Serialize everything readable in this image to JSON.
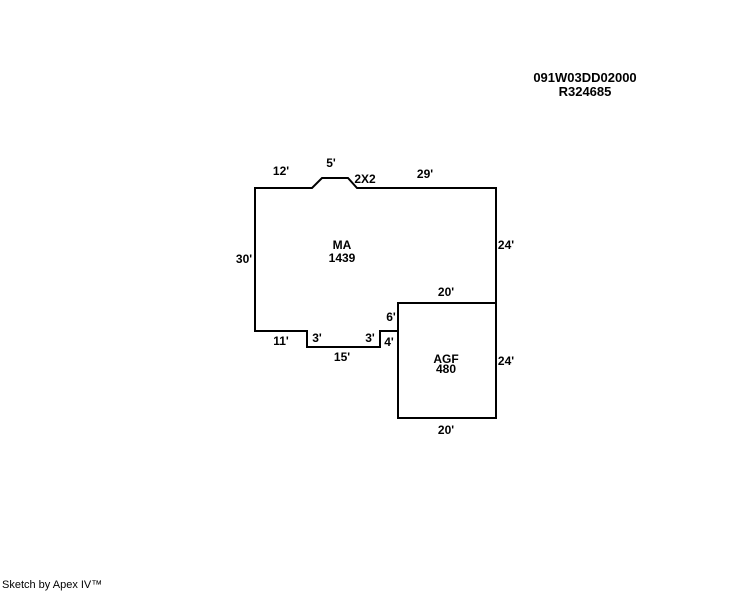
{
  "header": {
    "parcel_number": "091W03DD02000",
    "account_number": "R324685"
  },
  "areas": {
    "ma": {
      "code": "MA",
      "sqft": "1439"
    },
    "agf": {
      "code": "AGF",
      "sqft": "480"
    }
  },
  "dimensions": {
    "top_12": "12'",
    "bay_5": "5'",
    "bay_2x2": "2X2",
    "top_29": "29'",
    "right_24": "24'",
    "left_30": "30'",
    "agf_top_20": "20'",
    "step_6": "6'",
    "bottom_11": "11'",
    "step_3_left": "3'",
    "bottom_15": "15'",
    "step_3_right": "3'",
    "bottom_4": "4'",
    "agf_right_24": "24'",
    "agf_bottom_20": "20'"
  },
  "footer": {
    "credit": "Sketch by Apex IV™"
  }
}
